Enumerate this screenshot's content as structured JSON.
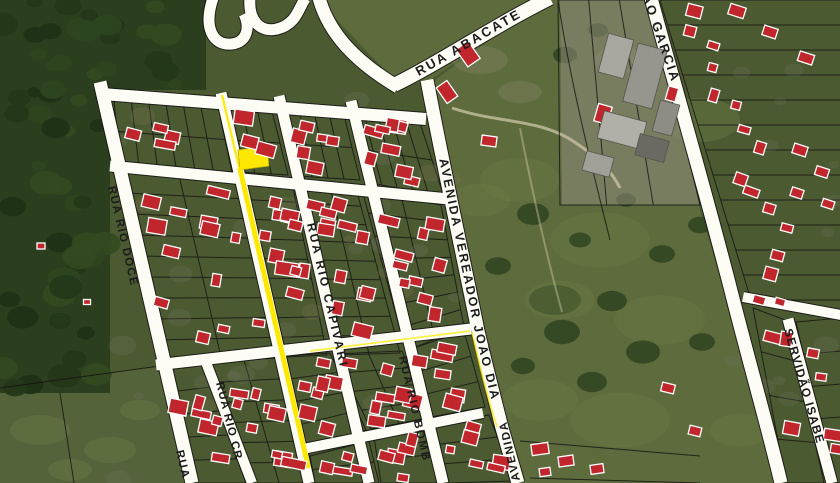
{
  "map": {
    "view": "satellite-cadastral-overlay",
    "street_labels": {
      "abacate": "RUA ABACATE",
      "rio_doce": "RUA RIO DOCE",
      "rio_doce_partial": "RUA",
      "rio_capivari": "RUA RIO CAPIVARI",
      "rio_cr_partial": "RUA RIO CR",
      "rio_bomb_partial": "RUA RIO BOMB",
      "avenida_vereador": "AVENIDA VEREADOR JOÃO DIA",
      "avenida_partial": "AVENIDA",
      "garcia_partial": "ÃO GARCIA",
      "servidao_isabel_partial": "SERVIDÃO ISABE"
    },
    "colors": {
      "road": "#fdfdf6",
      "road_casing": "#121212",
      "parcel_line": "#141414",
      "building_fill": "#c0262c",
      "building_stroke": "#ffffff",
      "industrial_fill": "#a0a098",
      "highlight": "#ffe800",
      "label": "#1b1b1b",
      "forest": "#2b3e1d",
      "field": "#55633a",
      "pasture": "#5d6b3d",
      "base": "#4c5a31",
      "trail": "#cfc6a8"
    },
    "highlights": {
      "selected_parcel": "yellow parcel highlight",
      "selected_route": "yellow route line"
    }
  }
}
